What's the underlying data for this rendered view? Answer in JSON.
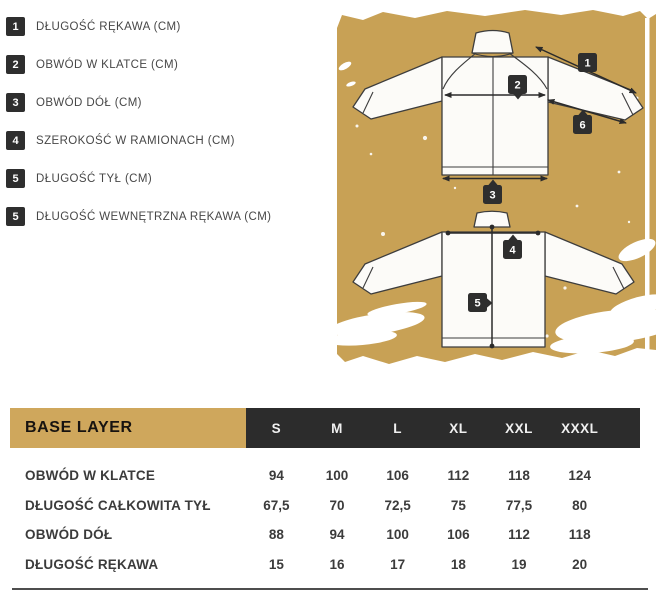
{
  "legend": {
    "items": [
      {
        "num": "1",
        "label": "DŁUGOŚĆ RĘKAWA (CM)"
      },
      {
        "num": "2",
        "label": "OBWÓD W KLATCE (CM)"
      },
      {
        "num": "3",
        "label": "OBWÓD DÓŁ (CM)"
      },
      {
        "num": "4",
        "label": "SZEROKOŚĆ W RAMIONACH (CM)"
      },
      {
        "num": "5",
        "label": "DŁUGOŚĆ TYŁ (CM)"
      },
      {
        "num": "5",
        "label": "DŁUGOŚĆ WEWNĘTRZNA RĘKAWA (CM)"
      }
    ]
  },
  "diagram": {
    "markers": {
      "sleeve_length": "1",
      "chest": "2",
      "bottom": "3",
      "shoulder_width": "4",
      "back_length": "5",
      "inner_sleeve": "6"
    }
  },
  "size_table": {
    "title": "BASE LAYER",
    "sizes": [
      "S",
      "M",
      "L",
      "XL",
      "XXL",
      "XXXL"
    ],
    "rows": [
      {
        "label": "OBWÓD W KLATCE",
        "values": [
          "94",
          "100",
          "106",
          "112",
          "118",
          "124"
        ]
      },
      {
        "label": "DŁUGOŚĆ CAŁKOWITA TYŁ",
        "values": [
          "67,5",
          "70",
          "72,5",
          "75",
          "77,5",
          "80"
        ]
      },
      {
        "label": "OBWÓD DÓŁ",
        "values": [
          "88",
          "94",
          "100",
          "106",
          "112",
          "118"
        ]
      },
      {
        "label": "DŁUGOŚĆ RĘKAWA",
        "values": [
          "15",
          "16",
          "17",
          "18",
          "19",
          "20"
        ]
      }
    ]
  },
  "colors": {
    "tan": "#c8a155",
    "dark": "#2e2e2e"
  }
}
